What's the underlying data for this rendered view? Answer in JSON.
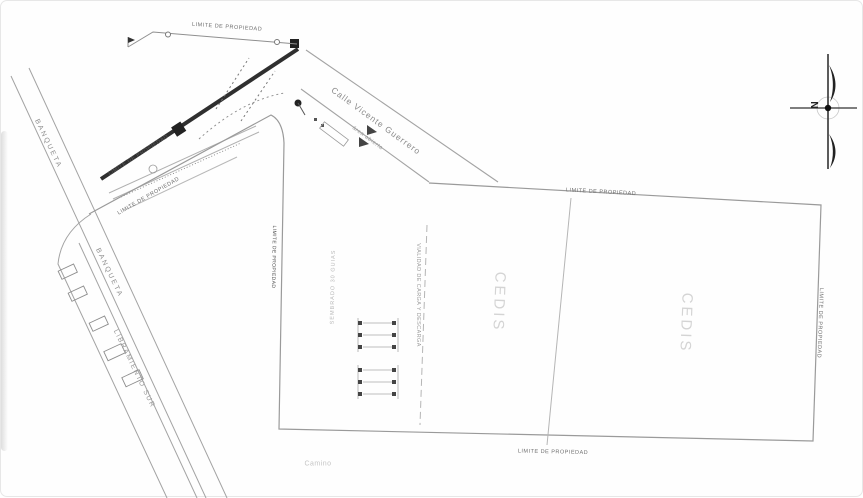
{
  "plan": {
    "labels": {
      "property_limit": "LIMITE DE PROPIEDAD",
      "sidewalk": "BANQUETA",
      "road_south": "LIBRAMIENTO SUR",
      "street_name": "Calle Vicente Guerrero",
      "street_sub": "área abierta",
      "building": "CEDIS",
      "guides": "SEMBRADO 30 GUIAS",
      "service_road": "VIALIDAD DE CARGA Y DESCARGA",
      "path_note": "Camino",
      "north": "N"
    },
    "colors": {
      "line": "#9a9a9a",
      "dark_line": "#2f2f2f",
      "label": "#6f6f6f",
      "faint_label": "#d4d4d4"
    }
  }
}
